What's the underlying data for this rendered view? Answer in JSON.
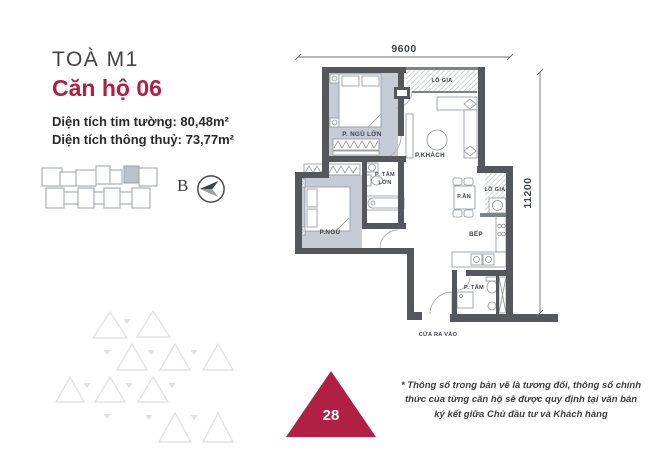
{
  "header": {
    "building": "TOÀ M1",
    "unit": "Căn hộ 06",
    "area_gross": "Diện tích tim tường: 80,48m²",
    "area_net": "Diện tích thông thuỷ: 73,77m²"
  },
  "key_plan": {
    "north_label": "B"
  },
  "floor_plan": {
    "dim_width": "9600",
    "dim_height": "11200",
    "rooms": {
      "master_bedroom": "P. NGỦ LỚN",
      "loggia_top": "LÔ GIA",
      "living": "P.KHÁCH",
      "bath_large_line1": "P. TẮM",
      "bath_large_line2": "LỚN",
      "bedroom2": "P.NGỦ",
      "dining": "P.ĂN",
      "loggia_right": "LÔ GIA",
      "kitchen": "BẾP",
      "bath_small": "P. TẮM",
      "entrance": "CỬA RA VÀO"
    }
  },
  "badge": {
    "number": "28"
  },
  "footnote": "* Thông số trong bản vẽ là tương đối, thông số chính thức của từng căn hộ sẽ được quy định tại văn bản ký kết giữa Chủ đầu tư và Khách hàng",
  "colors": {
    "accent": "#b11f45",
    "wall": "#54585d",
    "room_fill": "#c6ccd5"
  }
}
